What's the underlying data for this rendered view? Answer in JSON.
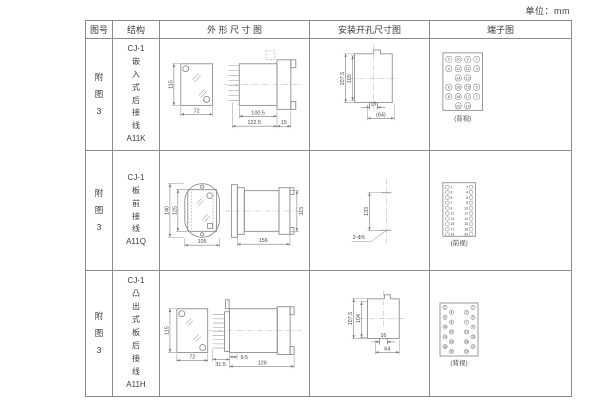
{
  "unit_label": "单位：mm",
  "header": {
    "col1": "图号",
    "col2": "结构",
    "col3": "外 形 尺 寸 图",
    "col4": "安装开孔尺寸图",
    "col5": "端子图"
  },
  "rows": [
    {
      "figure_no": "附\n图\n3",
      "structure": "CJ-1\n嵌\n入\n式\n后\n接\n线\nA11K",
      "outline": {
        "front_h": "115",
        "front_w": "72",
        "side_a": "100.5",
        "side_b": "122.5",
        "side_c": "15"
      },
      "install": {
        "outer_h": "107.5",
        "inner_h": "105",
        "slot_w": "16",
        "span_w": "(64)"
      },
      "terminal": {
        "view_label": "(背视)",
        "grid": [
          [
            "2",
            "10",
            "9",
            "1"
          ],
          [
            "4",
            "12",
            "11",
            "3"
          ],
          [
            "",
            "14",
            "13",
            ""
          ],
          [
            "6",
            "16",
            "15",
            "5"
          ],
          [
            "8",
            "18",
            "17",
            "7"
          ],
          [
            "",
            "20",
            "19",
            ""
          ]
        ]
      }
    },
    {
      "figure_no": "附\n图\n3",
      "structure": "CJ-1\n板\n前\n接\n线\nA11Q",
      "outline": {
        "front_h1": "140",
        "front_h2": "125",
        "front_w": "105",
        "side_len": "156",
        "side_h": "115"
      },
      "install": {
        "span": "133",
        "holes": "2-Φ5"
      },
      "terminal": {
        "view_label": "(前视)",
        "grid": [
          [
            "1",
            "",
            "",
            "2"
          ],
          [
            "3",
            "",
            "",
            "4"
          ],
          [
            "5",
            "",
            "",
            "6"
          ],
          [
            "7",
            "",
            "",
            "8"
          ],
          [
            "9",
            "",
            "",
            "10"
          ],
          [
            "11",
            "",
            "",
            "12"
          ],
          [
            "13",
            "",
            "",
            "14"
          ],
          [
            "15",
            "",
            "",
            "16"
          ],
          [
            "17",
            "",
            "",
            "18"
          ],
          [
            "19",
            "",
            "",
            "20"
          ]
        ]
      }
    },
    {
      "figure_no": "附\n图\n3",
      "structure": "CJ-1\n凸\n出\n式\n板\n后\n接\n线\nA11H",
      "outline": {
        "front_h": "115",
        "front_w": "72",
        "side_a": "31.5",
        "side_b": "9.5",
        "side_len": "126"
      },
      "install": {
        "outer_h": "107.5",
        "inner_h": "104",
        "slot_w": "16",
        "span_w": "64"
      },
      "terminal": {
        "view_label": "(背视)",
        "grid": [
          [
            "2",
            "",
            "",
            "1"
          ],
          [
            "",
            "4",
            "3",
            ""
          ],
          [
            "6",
            "",
            "",
            "5"
          ],
          [
            "",
            "8",
            "7",
            ""
          ],
          [
            "10",
            "",
            "",
            "9"
          ],
          [
            "",
            "12",
            "11",
            ""
          ],
          [
            "14",
            "",
            "",
            "13"
          ],
          [
            "",
            "16",
            "15",
            ""
          ],
          [
            "18",
            "",
            "",
            "17"
          ],
          [
            "",
            "20",
            "19",
            ""
          ]
        ]
      }
    }
  ]
}
